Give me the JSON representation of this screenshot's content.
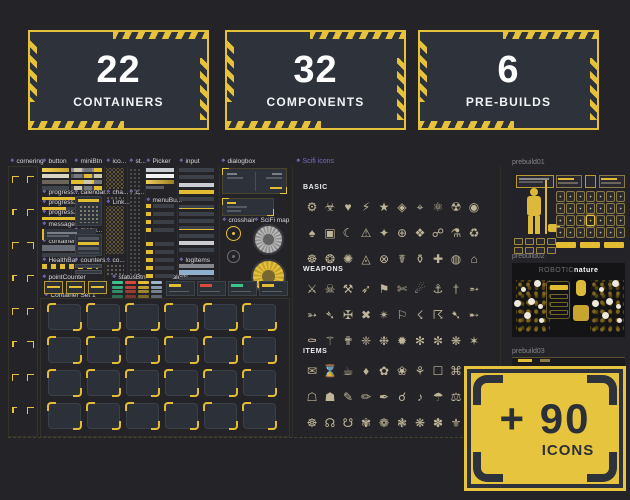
{
  "stats": [
    {
      "value": "22",
      "label": "CONTAINERS"
    },
    {
      "value": "32",
      "label": "COMPONENTS"
    },
    {
      "value": "6",
      "label": "PRE-BUILDS"
    }
  ],
  "component_labels": [
    {
      "id": "cornering",
      "text": "cornering"
    },
    {
      "id": "button",
      "text": "button"
    },
    {
      "id": "minibtn",
      "text": "miniBtn"
    },
    {
      "id": "ico",
      "text": "ico..."
    },
    {
      "id": "st",
      "text": "st..."
    },
    {
      "id": "picker",
      "text": "Picker"
    },
    {
      "id": "input",
      "text": "input"
    },
    {
      "id": "dialogbox",
      "text": "dialogbox"
    },
    {
      "id": "progress1",
      "text": "progress..."
    },
    {
      "id": "calendar",
      "text": "calendar..."
    },
    {
      "id": "cha",
      "text": "cha..."
    },
    {
      "id": "c1",
      "text": "c..."
    },
    {
      "id": "progress2",
      "text": "progress..."
    },
    {
      "id": "link",
      "text": "Link..."
    },
    {
      "id": "menubu",
      "text": "menuBu..."
    },
    {
      "id": "progress3",
      "text": "progress..."
    },
    {
      "id": "crosshair",
      "text": "crosshair"
    },
    {
      "id": "scifimap",
      "text": "SciFi map"
    },
    {
      "id": "message",
      "text": "message..."
    },
    {
      "id": "menu",
      "text": "menu..."
    },
    {
      "id": "containers",
      "text": "containers"
    },
    {
      "id": "healthbar",
      "text": "HealthBar"
    },
    {
      "id": "counters",
      "text": "counters..."
    },
    {
      "id": "co",
      "text": "co..."
    },
    {
      "id": "logitems",
      "text": "logItems"
    },
    {
      "id": "pointcounter",
      "text": "pointCounter"
    },
    {
      "id": "statusbtn",
      "text": "statusBtn"
    },
    {
      "id": "alerts",
      "text": "alerts"
    },
    {
      "id": "containerset",
      "text": "Container Set 1"
    }
  ],
  "icons_panel": {
    "title": "Scifi icons",
    "groups": [
      {
        "name": "BASIC",
        "icons": [
          {
            "n": "gear",
            "g": "⚙"
          },
          {
            "n": "biohazard",
            "g": "☣"
          },
          {
            "n": "heart",
            "g": "♥"
          },
          {
            "n": "bolt",
            "g": "⚡"
          },
          {
            "n": "star",
            "g": "★"
          },
          {
            "n": "gem",
            "g": "◈"
          },
          {
            "n": "target",
            "g": "⌖"
          },
          {
            "n": "atom",
            "g": "⚛"
          },
          {
            "n": "radiation",
            "g": "☢"
          },
          {
            "n": "core",
            "g": "◉"
          },
          {
            "n": "spade",
            "g": "♠"
          },
          {
            "n": "module",
            "g": "▣"
          },
          {
            "n": "moon",
            "g": "☾"
          },
          {
            "n": "warning",
            "g": "⚠"
          },
          {
            "n": "spark",
            "g": "✦"
          },
          {
            "n": "plus-orb",
            "g": "⊕"
          },
          {
            "n": "crystal",
            "g": "❖"
          },
          {
            "n": "orbit",
            "g": "☍"
          },
          {
            "n": "alembic",
            "g": "⚗"
          },
          {
            "n": "recycle",
            "g": "♻"
          },
          {
            "n": "wheel",
            "g": "☸"
          },
          {
            "n": "sun-core",
            "g": "❂"
          },
          {
            "n": "burst",
            "g": "✺"
          },
          {
            "n": "prism",
            "g": "◬"
          },
          {
            "n": "lock-orb",
            "g": "⊗"
          },
          {
            "n": "caduceus",
            "g": "☤"
          },
          {
            "n": "urn",
            "g": "⚱"
          },
          {
            "n": "medkit-cross",
            "g": "✚"
          },
          {
            "n": "disc",
            "g": "◍"
          },
          {
            "n": "bunker",
            "g": "⌂"
          }
        ]
      },
      {
        "name": "WEAPONS",
        "icons": [
          {
            "n": "crossed-swords",
            "g": "⚔"
          },
          {
            "n": "skull",
            "g": "☠"
          },
          {
            "n": "war-hammers",
            "g": "⚒"
          },
          {
            "n": "arrow-volley",
            "g": "➶"
          },
          {
            "n": "war-banner",
            "g": "⚑"
          },
          {
            "n": "shears",
            "g": "✄"
          },
          {
            "n": "comet",
            "g": "☄"
          },
          {
            "n": "anchor-hook",
            "g": "⚓"
          },
          {
            "n": "dagger",
            "g": "†"
          },
          {
            "n": "tracer-round",
            "g": "➵"
          },
          {
            "n": "arrow",
            "g": "➳"
          },
          {
            "n": "spear",
            "g": "➴"
          },
          {
            "n": "blade-cross",
            "g": "✠"
          },
          {
            "n": "strike",
            "g": "✖"
          },
          {
            "n": "blast",
            "g": "✴"
          },
          {
            "n": "flag",
            "g": "⚐"
          },
          {
            "n": "lightning",
            "g": "☇"
          },
          {
            "n": "storm-bolt",
            "g": "☈"
          },
          {
            "n": "arrow-drop",
            "g": "➷"
          },
          {
            "n": "bolt-shot",
            "g": "➸"
          },
          {
            "n": "coffin",
            "g": "⚰"
          },
          {
            "n": "serpent-staff",
            "g": "⚚"
          },
          {
            "n": "ankh-blade",
            "g": "✟"
          },
          {
            "n": "shuriken",
            "g": "❈"
          },
          {
            "n": "flail-star",
            "g": "❉"
          },
          {
            "n": "mine-burst",
            "g": "✹"
          },
          {
            "n": "spike-star",
            "g": "✻"
          },
          {
            "n": "caltrop",
            "g": "✼"
          },
          {
            "n": "razor-star",
            "g": "❋"
          },
          {
            "n": "edge-star",
            "g": "✶"
          }
        ]
      },
      {
        "name": "ITEMS",
        "icons": [
          {
            "n": "scroll-letter",
            "g": "✉"
          },
          {
            "n": "hourglass",
            "g": "⌛"
          },
          {
            "n": "ration-cup",
            "g": "☕"
          },
          {
            "n": "gem-stone",
            "g": "♦"
          },
          {
            "n": "flower",
            "g": "✿"
          },
          {
            "n": "bloom",
            "g": "❀"
          },
          {
            "n": "sprig",
            "g": "⚘"
          },
          {
            "n": "crate",
            "g": "☐"
          },
          {
            "n": "artifact-key",
            "g": "⌘"
          },
          {
            "n": "hot-spring",
            "g": "♨"
          },
          {
            "n": "shrine-piece",
            "g": "☖"
          },
          {
            "n": "token",
            "g": "☗"
          },
          {
            "n": "pen",
            "g": "✎"
          },
          {
            "n": "pencil",
            "g": "✏"
          },
          {
            "n": "quill",
            "g": "✒"
          },
          {
            "n": "link-node",
            "g": "☌"
          },
          {
            "n": "resonator",
            "g": "♪"
          },
          {
            "n": "umbrella",
            "g": "☂"
          },
          {
            "n": "scales",
            "g": "⚖"
          },
          {
            "n": "flask",
            "g": "⚗"
          },
          {
            "n": "relic-wheel",
            "g": "☸"
          },
          {
            "n": "ascending-node",
            "g": "☊"
          },
          {
            "n": "descending-node",
            "g": "☋"
          },
          {
            "n": "blossom",
            "g": "✾"
          },
          {
            "n": "petal-ring",
            "g": "❁"
          },
          {
            "n": "medal-flower",
            "g": "❃"
          },
          {
            "n": "cluster",
            "g": "❋"
          },
          {
            "n": "leaf-star",
            "g": "✽"
          },
          {
            "n": "fleur",
            "g": "⚜"
          },
          {
            "n": "yin-yang",
            "g": "☯"
          }
        ]
      }
    ]
  },
  "status_colors": [
    "#3cc48c",
    "#d9493c",
    "#e2bc33",
    "#9fb6c9"
  ],
  "alert_colors": [
    "#e2bc33",
    "#d9493c",
    "#3cc48c",
    "#e2bc33"
  ],
  "prebuilds": [
    {
      "label": "prebuild01"
    },
    {
      "label": "prebuild02",
      "title": {
        "muted": "ROBOTIC",
        "strong": "nature"
      }
    },
    {
      "label": "prebuild03"
    }
  ],
  "plus_card": {
    "value": "+ 90",
    "label": "ICONS"
  },
  "colors": {
    "accent": "#e6c23b",
    "card_bg": "#2d323b",
    "page_bg": "#242428",
    "component_purple": "#8f7ad6",
    "icon_beige": "#d5caa9"
  }
}
